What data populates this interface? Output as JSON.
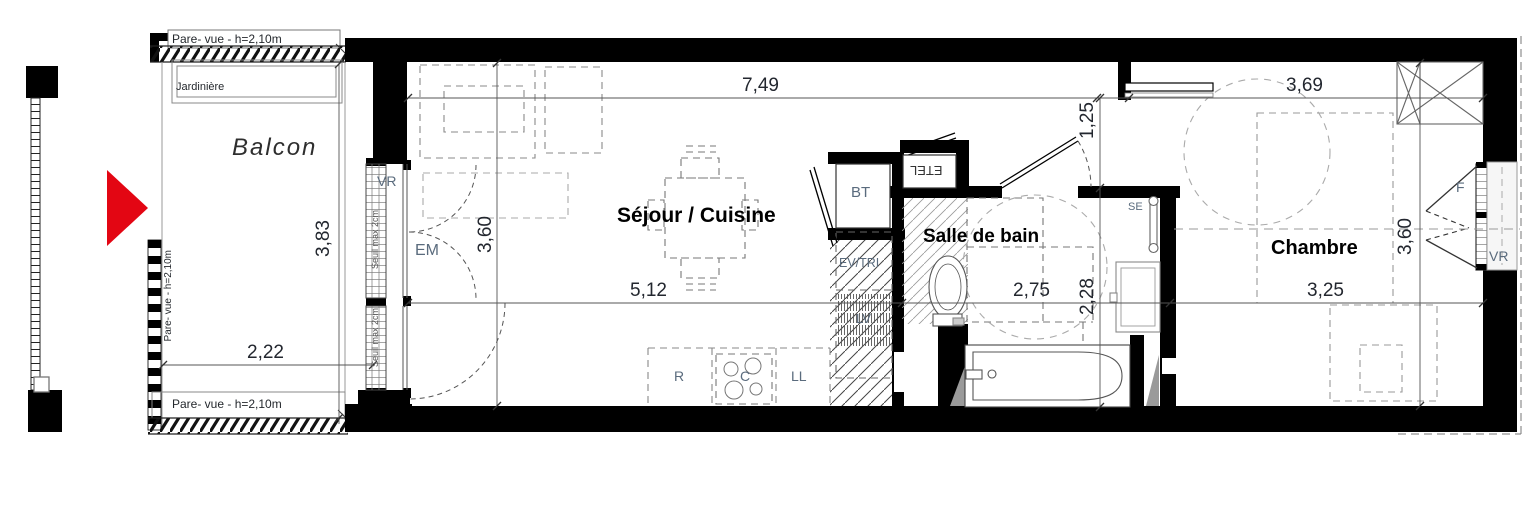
{
  "colors": {
    "accent_red": "#e30613",
    "wall_black": "#000000",
    "equipment_blue": "#5a6b7d",
    "dimension_text": "#23272f"
  },
  "rooms": {
    "balcon": "Balcon",
    "sejour": "Séjour / Cuisine",
    "salle_de_bain": "Salle de bain",
    "chambre": "Chambre"
  },
  "annotations": {
    "pare_vue_top": "Pare- vue - h=2,10m",
    "pare_vue_left": "Pare- vue - h=2,10m",
    "pare_vue_bottom": "Pare- vue - h=2,10m",
    "jardiniere": "Jardinière",
    "seuil_upper": "Seuil max 2cm",
    "seuil_lower": "Seuil max 2cm"
  },
  "equipment": {
    "vr_left": "VR",
    "em": "EM",
    "bt": "BT",
    "etel": "ETEL",
    "ev_tri": "EV/TRI",
    "lv": "LV",
    "fridge": "R",
    "cooktop": "C",
    "washer": "LL",
    "towel_dryer": "SE",
    "window_f": "F",
    "vr_right": "VR"
  },
  "dimensions": {
    "sejour_width": "7,49",
    "chambre_width": "3,69",
    "hall_depth": "1,25",
    "balcon_depth": "3,83",
    "sejour_height": "3,60",
    "sejour_inner_width": "5,12",
    "sdb_width": "2,75",
    "sdb_height": "2,28",
    "chambre_inner_width": "3,25",
    "balcon_width": "2,22",
    "chambre_height": "3,60"
  }
}
